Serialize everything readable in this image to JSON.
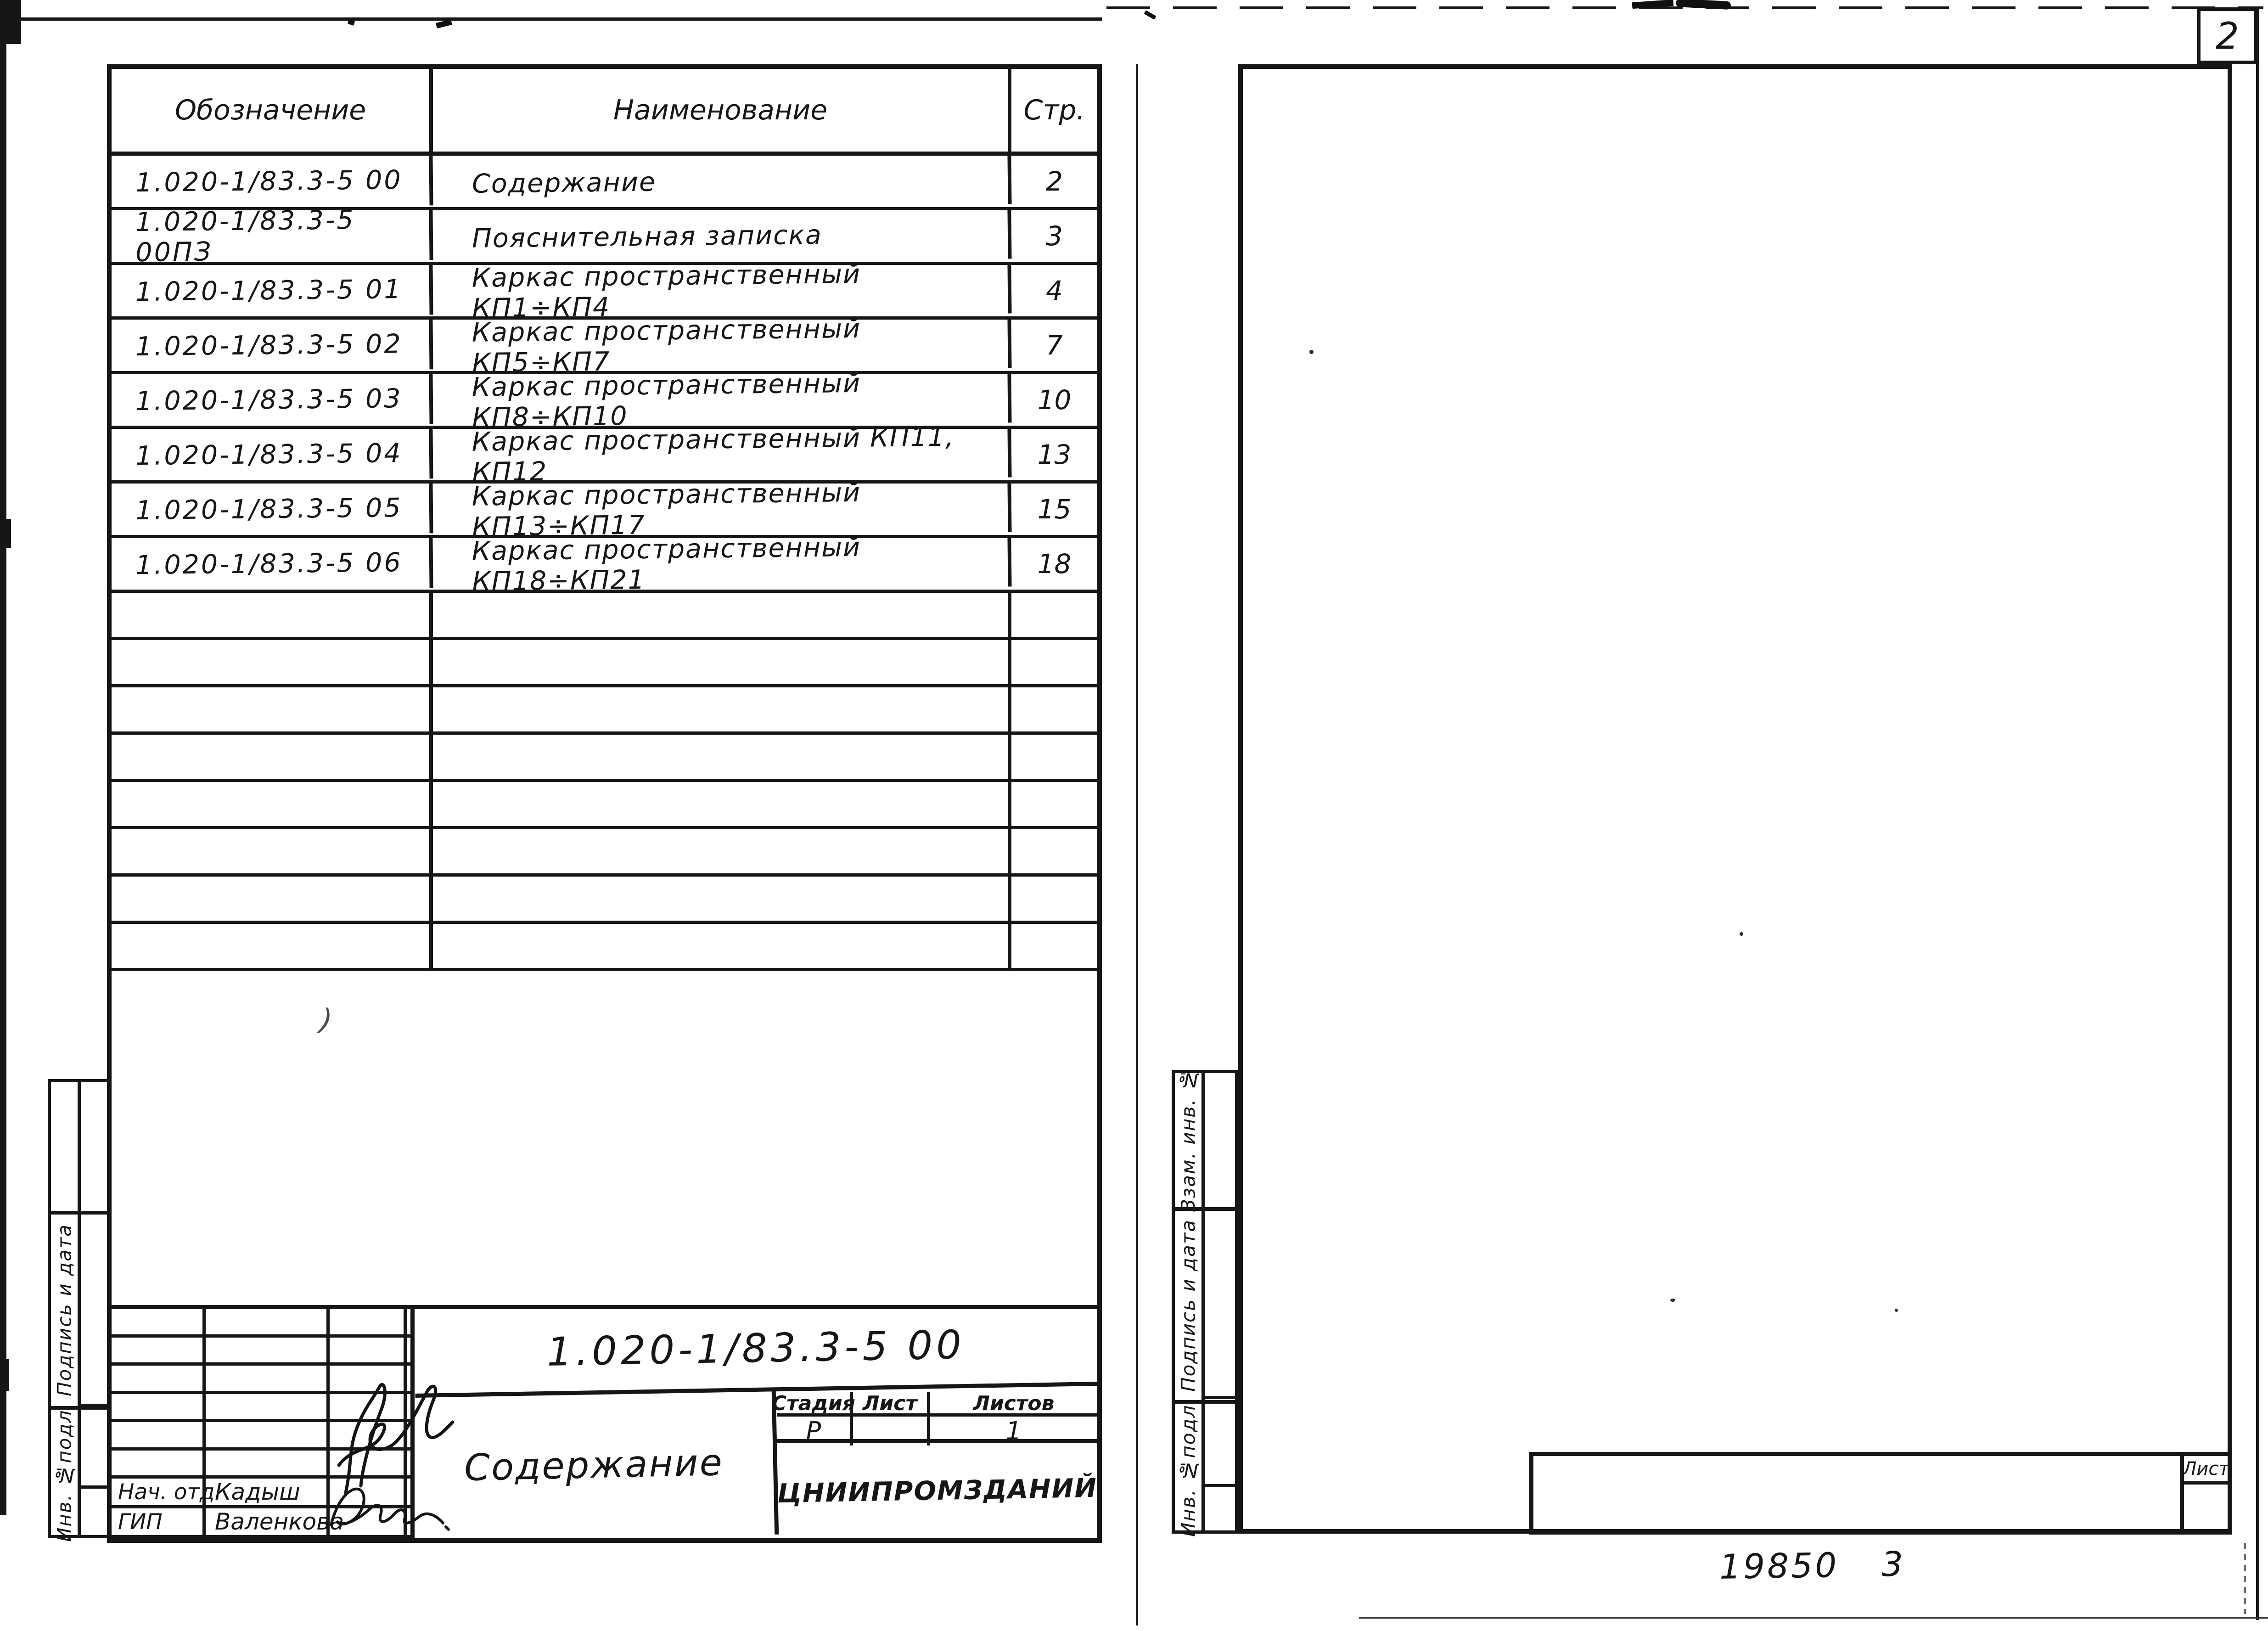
{
  "scan": {
    "page_corner_number": "2",
    "sheet_box_label": "Лист",
    "stamp_number": "19850",
    "stamp_sheet": "3",
    "stray_mark": ")"
  },
  "toc": {
    "headers": {
      "designation": "Обозначение",
      "name": "Наименование",
      "page": "Стр."
    },
    "rows": [
      {
        "designation": "1.020-1/83.3-5 00",
        "name": "Содержание",
        "page": "2"
      },
      {
        "designation": "1.020-1/83.3-5 00ПЗ",
        "name": "Пояснительная записка",
        "page": "3"
      },
      {
        "designation": "1.020-1/83.3-5 01",
        "name": "Каркас пространственный КП1÷КП4",
        "page": "4"
      },
      {
        "designation": "1.020-1/83.3-5 02",
        "name": "Каркас пространственный КП5÷КП7",
        "page": "7"
      },
      {
        "designation": "1.020-1/83.3-5 03",
        "name": "Каркас пространственный КП8÷КП10",
        "page": "10"
      },
      {
        "designation": "1.020-1/83.3-5 04",
        "name": "Каркас пространственный КП11, КП12",
        "page": "13"
      },
      {
        "designation": "1.020-1/83.3-5 05",
        "name": "Каркас пространственный КП13÷КП17",
        "page": "15"
      },
      {
        "designation": "1.020-1/83.3-5 06",
        "name": "Каркас пространственный КП18÷КП21",
        "page": "18"
      }
    ]
  },
  "title_block": {
    "doc_number": "1.020-1/83.3-5 00",
    "doc_title": "Содержание",
    "organization": "ЦНИИПРОМЗДАНИЙ",
    "stage_label": "Стадия",
    "sheet_label": "Лист",
    "sheets_label": "Листов",
    "stage_value": "Р",
    "sheet_value": "",
    "sheets_value": "1",
    "sig_rows": [
      {
        "role": "Нач. отд.",
        "name": "Кадыш"
      },
      {
        "role": "ГИП",
        "name": "Валенкова"
      }
    ]
  },
  "margin_labels": {
    "left_page": [
      "",
      "Подпись и дата",
      "Инв. №подл."
    ],
    "right_page": [
      "Взам. инв. №",
      "Подпись и дата",
      "Инв. №подл."
    ]
  }
}
